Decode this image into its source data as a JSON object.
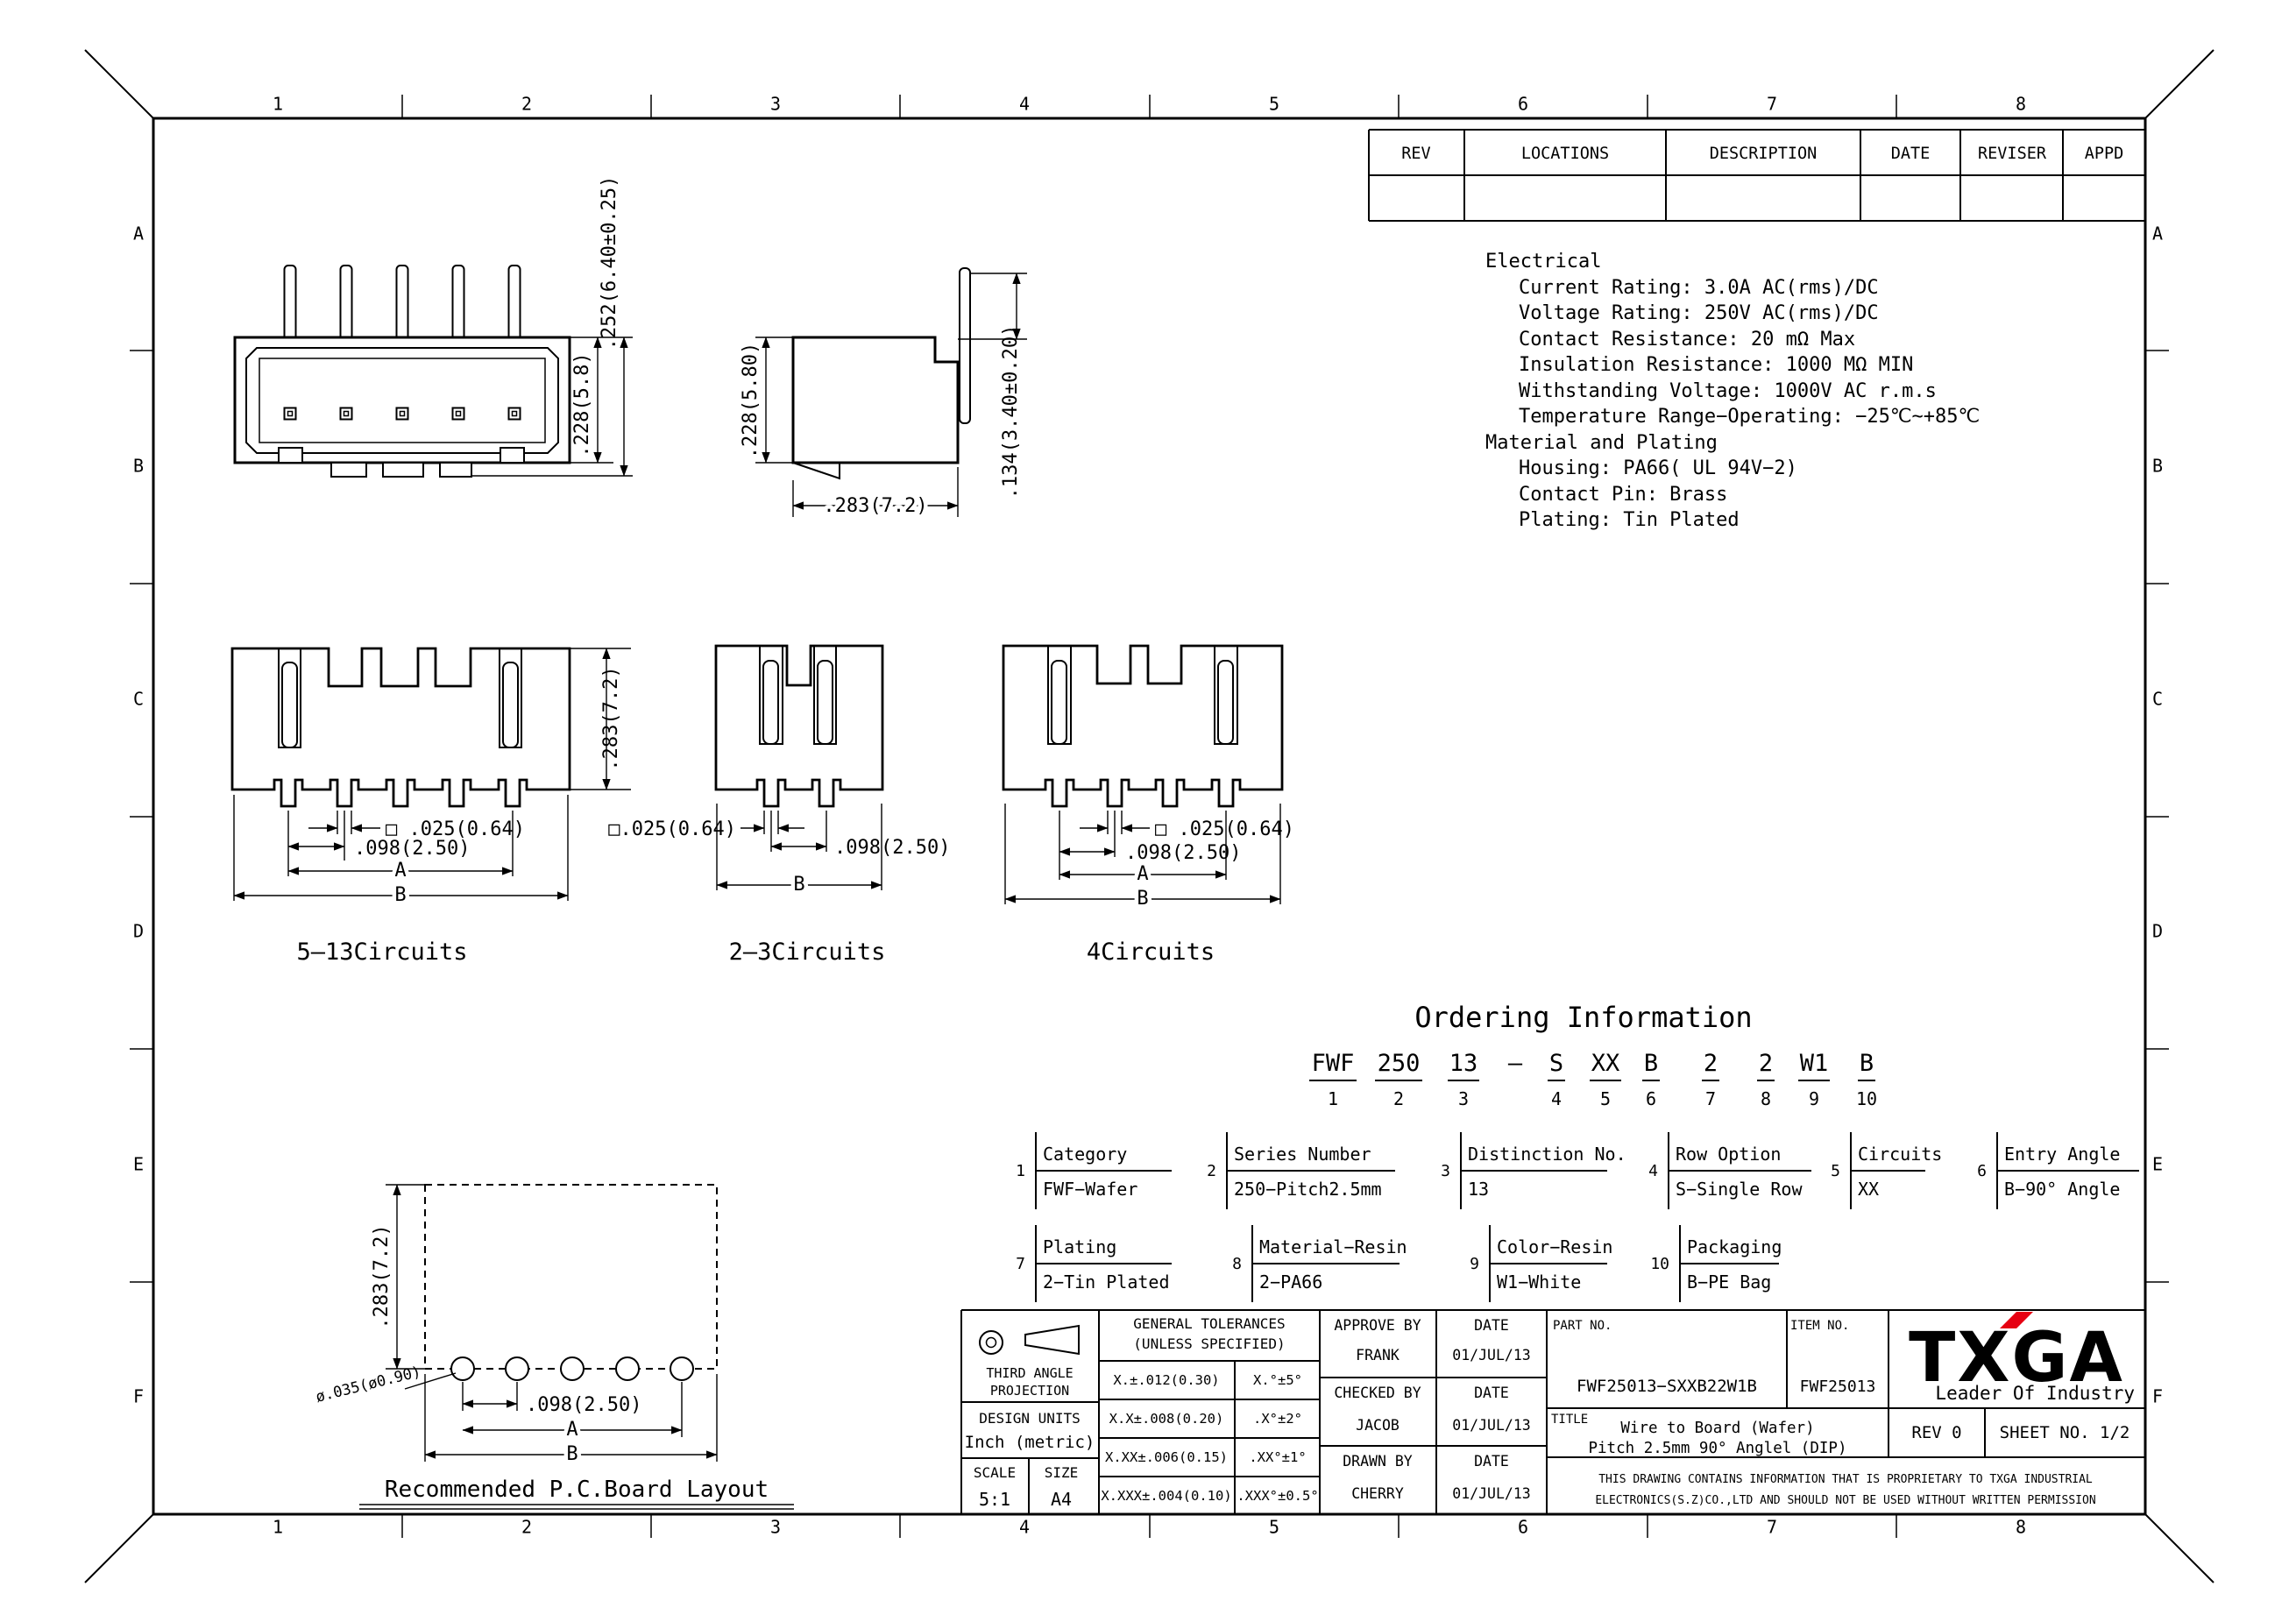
{
  "frame": {
    "columns": [
      "1",
      "2",
      "3",
      "4",
      "5",
      "6",
      "7",
      "8"
    ],
    "rows": [
      "A",
      "B",
      "C",
      "D",
      "E",
      "F"
    ]
  },
  "revision_table": {
    "headers": [
      "REV",
      "LOCATIONS",
      "DESCRIPTION",
      "DATE",
      "REVISER",
      "APPD"
    ]
  },
  "specs": {
    "lines": [
      "Electrical",
      "Current Rating: 3.0A AC(rms)/DC",
      "Voltage Rating: 250V AC(rms)/DC",
      "Contact Resistance: 20 mΩ Max",
      "Insulation Resistance: 1000 MΩ MIN",
      "Withstanding Voltage: 1000V AC r.m.s",
      "Temperature Range−Operating: −25℃~+85℃",
      "Material and Plating",
      "Housing: PA66( UL 94V−2)",
      "Contact Pin: Brass",
      "Plating: Tin Plated"
    ]
  },
  "views": {
    "front": {
      "dim_inner": ".228(5.8)",
      "dim_outer": ".252(6.40±0.25)"
    },
    "side": {
      "dim_height": ".228(5.80)",
      "dim_width": ".283(7.2)",
      "dim_pin": ".134(3.40±0.20)"
    },
    "circuits513": {
      "caption": "5–13Circuits",
      "dim_height": ".283(7.2)",
      "dim_square": "□ .025(0.64)",
      "dim_pitch": ".098(2.50)",
      "label_a": "A",
      "label_b": "B"
    },
    "circuits23": {
      "caption": "2–3Circuits",
      "dim_square": "□.025(0.64)",
      "dim_pitch": ".098(2.50)",
      "label_b": "B"
    },
    "circuits4": {
      "caption": "4Circuits",
      "dim_square": "□ .025(0.64)",
      "dim_pitch": ".098(2.50)",
      "label_a": "A",
      "label_b": "B"
    },
    "pcb": {
      "caption": "Recommended P.C.Board Layout",
      "dim_height": ".283(7.2)",
      "dim_hole": "ø.035(ø0.90)",
      "dim_pitch": ".098(2.50)",
      "label_a": "A",
      "label_b": "B"
    }
  },
  "ordering": {
    "title": "Ordering Information",
    "code_parts": [
      {
        "code": "FWF",
        "num": "1"
      },
      {
        "code": "250",
        "num": "2"
      },
      {
        "code": "13",
        "num": "3"
      },
      {
        "code": "—",
        "num": ""
      },
      {
        "code": "S",
        "num": "4"
      },
      {
        "code": "XX",
        "num": "5"
      },
      {
        "code": "B",
        "num": "6"
      },
      {
        "code": "2",
        "num": "7"
      },
      {
        "code": "2",
        "num": "8"
      },
      {
        "code": "W1",
        "num": "9"
      },
      {
        "code": "B",
        "num": "10"
      }
    ],
    "fields": [
      {
        "num": "1",
        "label": "Category",
        "value": "FWF−Wafer"
      },
      {
        "num": "2",
        "label": "Series Number",
        "value": "250−Pitch2.5mm"
      },
      {
        "num": "3",
        "label": "Distinction No.",
        "value": "13"
      },
      {
        "num": "4",
        "label": "Row Option",
        "value": "S−Single Row"
      },
      {
        "num": "5",
        "label": "Circuits",
        "value": "XX"
      },
      {
        "num": "6",
        "label": "Entry Angle",
        "value": "B−90° Angle"
      },
      {
        "num": "7",
        "label": "Plating",
        "value": "2−Tin Plated"
      },
      {
        "num": "8",
        "label": "Material−Resin",
        "value": "2−PA66"
      },
      {
        "num": "9",
        "label": "Color−Resin",
        "value": "W1−White"
      },
      {
        "num": "10",
        "label": "Packaging",
        "value": "B−PE Bag"
      }
    ]
  },
  "title_block": {
    "projection_line1": "THIRD ANGLE",
    "projection_line2": "PROJECTION",
    "tolerances_header1": "GENERAL TOLERANCES",
    "tolerances_header2": "(UNLESS SPECIFIED)",
    "tolerance_rows": [
      [
        "X.±.012(0.30)",
        "X.°±5°"
      ],
      [
        "X.X±.008(0.20)",
        ".X°±2°"
      ],
      [
        "X.XX±.006(0.15)",
        ".XX°±1°"
      ],
      [
        "X.XXX±.004(0.10)",
        ".XXX°±0.5°"
      ]
    ],
    "design_units_label": "DESIGN UNITS",
    "design_units_value": "Inch (metric)",
    "scale_label": "SCALE",
    "scale_value": "5:1",
    "size_label": "SIZE",
    "size_value": "A4",
    "signoff": [
      {
        "role": "APPROVE BY",
        "name": "FRANK",
        "date_label": "DATE",
        "date": "01/JUL/13"
      },
      {
        "role": "CHECKED BY",
        "name": "JACOB",
        "date_label": "DATE",
        "date": "01/JUL/13"
      },
      {
        "role": "DRAWN BY",
        "name": "CHERRY",
        "date_label": "DATE",
        "date": "01/JUL/13"
      }
    ],
    "part_no_label": "PART NO.",
    "part_no": "FWF25013−SXXB22W1B",
    "item_no_label": "ITEM NO.",
    "item_no": "FWF25013",
    "title_label": "TITLE",
    "title_line1": "Wire to Board (Wafer)",
    "title_line2": "Pitch 2.5mm 90° Anglel (DIP)",
    "rev": "REV 0",
    "sheet": "SHEET NO. 1/2",
    "logo_text": "TXGA",
    "logo_tagline": "Leader Of Industry",
    "logo_accent_color": "#e60012",
    "proprietary_line1": "THIS DRAWING CONTAINS INFORMATION THAT IS PROPRIETARY TO TXGA INDUSTRIAL",
    "proprietary_line2": "ELECTRONICS(S.Z)CO.,LTD AND SHOULD NOT BE USED WITHOUT WRITTEN PERMISSION"
  }
}
